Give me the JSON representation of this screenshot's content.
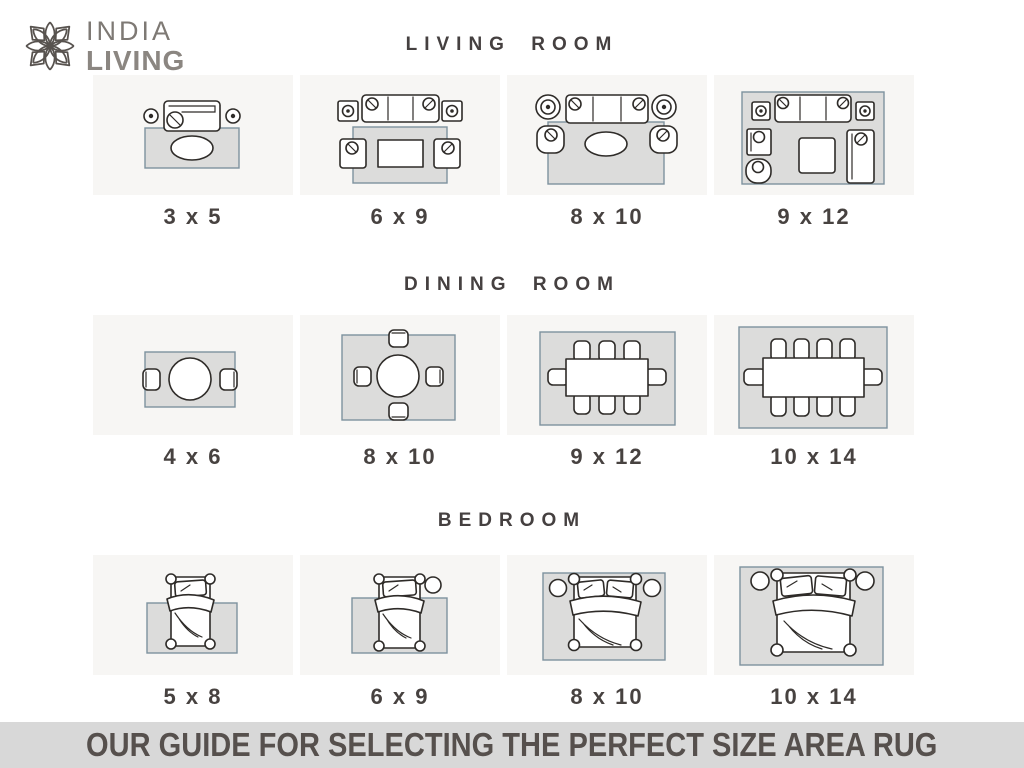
{
  "brand": {
    "line1": "INDIA",
    "line2": "LIVING",
    "logo_icon": "lotus-flower-icon"
  },
  "sections": [
    {
      "id": "living-room",
      "title": "LIVING ROOM",
      "panels": [
        {
          "label": "3 x 5",
          "diagram": "loveseat-side-dots-oval-coffee-table-small-rug"
        },
        {
          "label": "6 x 9",
          "diagram": "sofa-two-armchairs-rect-coffee-table-front-legs-on-rug"
        },
        {
          "label": "8 x 10",
          "diagram": "sofa-two-armchairs-oval-coffee-table-larger-rug"
        },
        {
          "label": "9 x 12",
          "diagram": "all-furniture-on-rug-sofa-chairs-chaise-square-table"
        }
      ]
    },
    {
      "id": "dining-room",
      "title": "DINING ROOM",
      "panels": [
        {
          "label": "4 x 6",
          "diagram": "round-table-2-chairs"
        },
        {
          "label": "8 x 10",
          "diagram": "round-table-4-chairs"
        },
        {
          "label": "9 x 12",
          "diagram": "rect-table-8-chairs"
        },
        {
          "label": "10 x 14",
          "diagram": "rect-table-10-chairs"
        }
      ]
    },
    {
      "id": "bedroom",
      "title": "BEDROOM",
      "panels": [
        {
          "label": "5 x 8",
          "diagram": "twin-bed-rug-under-lower-half"
        },
        {
          "label": "6 x 9",
          "diagram": "twin-bed-one-nightstand-larger-rug"
        },
        {
          "label": "8 x 10",
          "diagram": "double-bed-two-nightstands-rug-under-bed"
        },
        {
          "label": "10 x 14",
          "diagram": "double-bed-two-nightstands-full-rug"
        }
      ]
    }
  ],
  "footer": {
    "text": "OUR GUIDE FOR SELECTING THE PERFECT SIZE AREA RUG"
  },
  "colors": {
    "panel_bg": "#f7f6f4",
    "rug_fill": "#dcdcdb",
    "rug_border": "#7d929e",
    "line_art": "#2e2b28",
    "heading_text": "#454040",
    "label_text": "#474240",
    "footer_bg": "#d8d8d8",
    "footer_text": "#56504d",
    "logo_gray": "#8b8681"
  }
}
